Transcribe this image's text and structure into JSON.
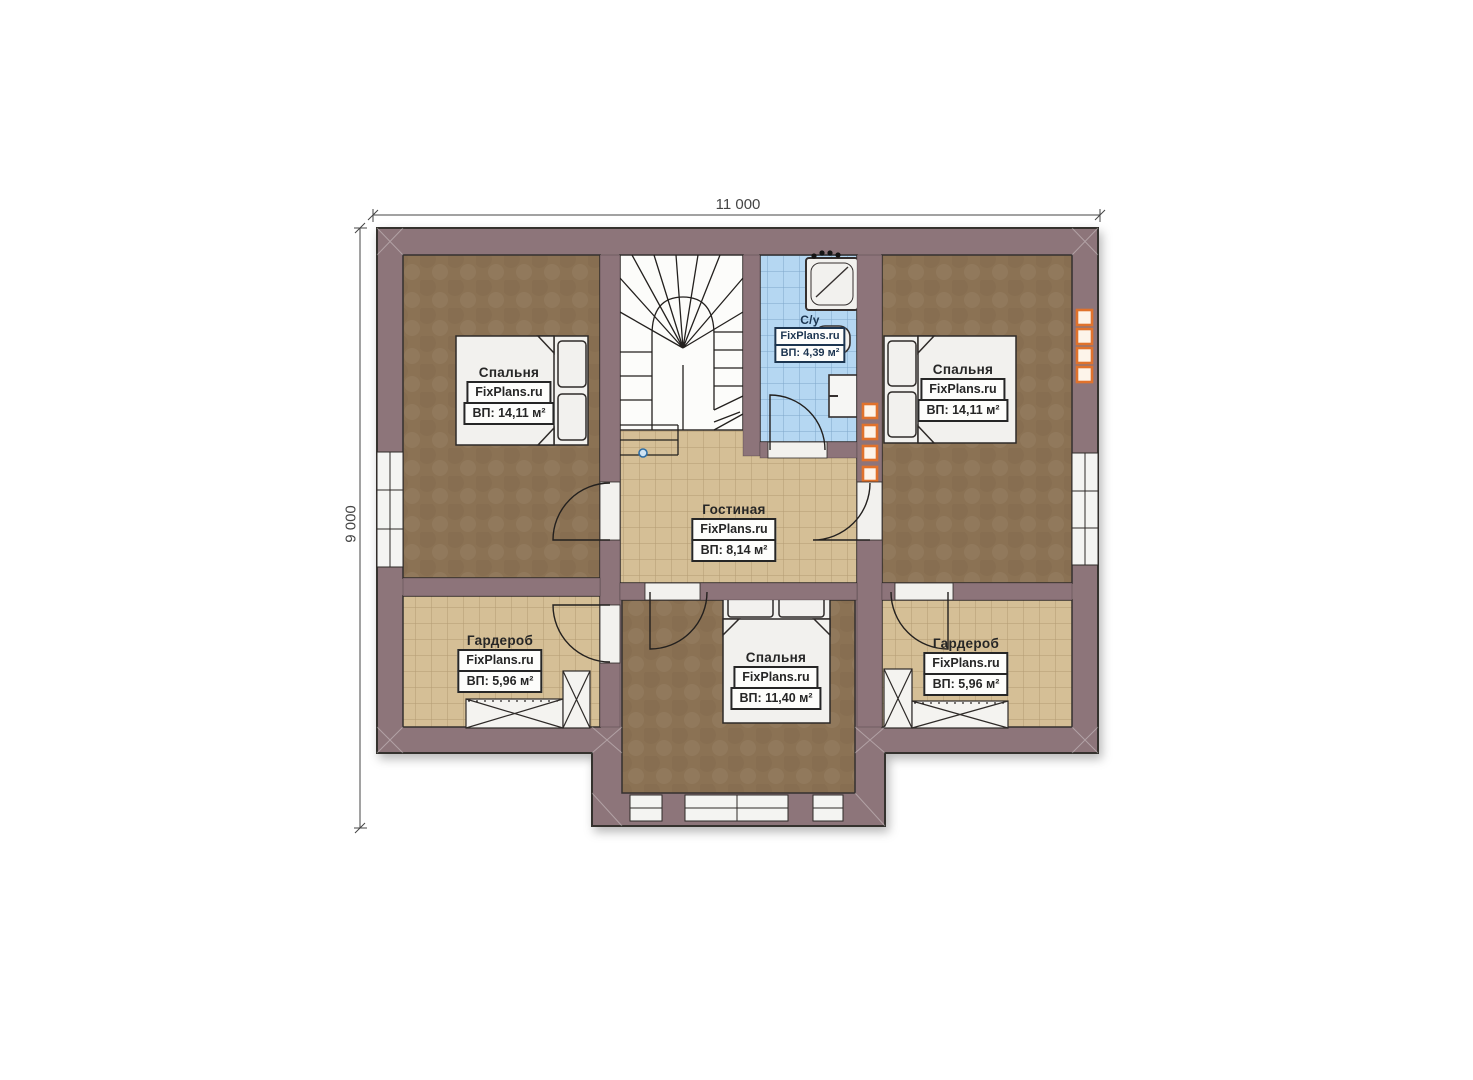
{
  "dimensions": {
    "width_label": "11 000",
    "height_label": "9 000"
  },
  "rooms": [
    {
      "id": "bedroom-left",
      "name": "Спальня",
      "watermark": "FixPlans.ru",
      "area": "ВП: 14,11 м²"
    },
    {
      "id": "bathroom",
      "name": "С/у",
      "watermark": "FixPlans.ru",
      "area": "ВП: 4,39 м²"
    },
    {
      "id": "bedroom-right",
      "name": "Спальня",
      "watermark": "FixPlans.ru",
      "area": "ВП: 14,11 м²"
    },
    {
      "id": "living-room",
      "name": "Гостиная",
      "watermark": "FixPlans.ru",
      "area": "ВП: 8,14 м²"
    },
    {
      "id": "wardrobe-left",
      "name": "Гардероб",
      "watermark": "FixPlans.ru",
      "area": "ВП: 5,96 м²"
    },
    {
      "id": "bedroom-center",
      "name": "Спальня",
      "watermark": "FixPlans.ru",
      "area": "ВП: 11,40 м²"
    },
    {
      "id": "wardrobe-right",
      "name": "Гардероб",
      "watermark": "FixPlans.ru",
      "area": "ВП: 5,96 м²"
    }
  ],
  "colors": {
    "wall": "#8D747A",
    "ink": "#35302F",
    "floor_brown": "#8B7254",
    "tile_tan": "#D5BF96",
    "tile_tan_line": "#B49B73",
    "tile_blue": "#B5D7F2",
    "tile_blue_line": "#7EA7CB",
    "vent_orange": "#E0722C",
    "vent_fill": "#FDF4EA",
    "fixture_white": "#F2F1EE",
    "label_ink": "#262626",
    "bath_ink": "#1C3550",
    "dim_ink": "#454545",
    "stair_dot": "#2E6DA4"
  }
}
